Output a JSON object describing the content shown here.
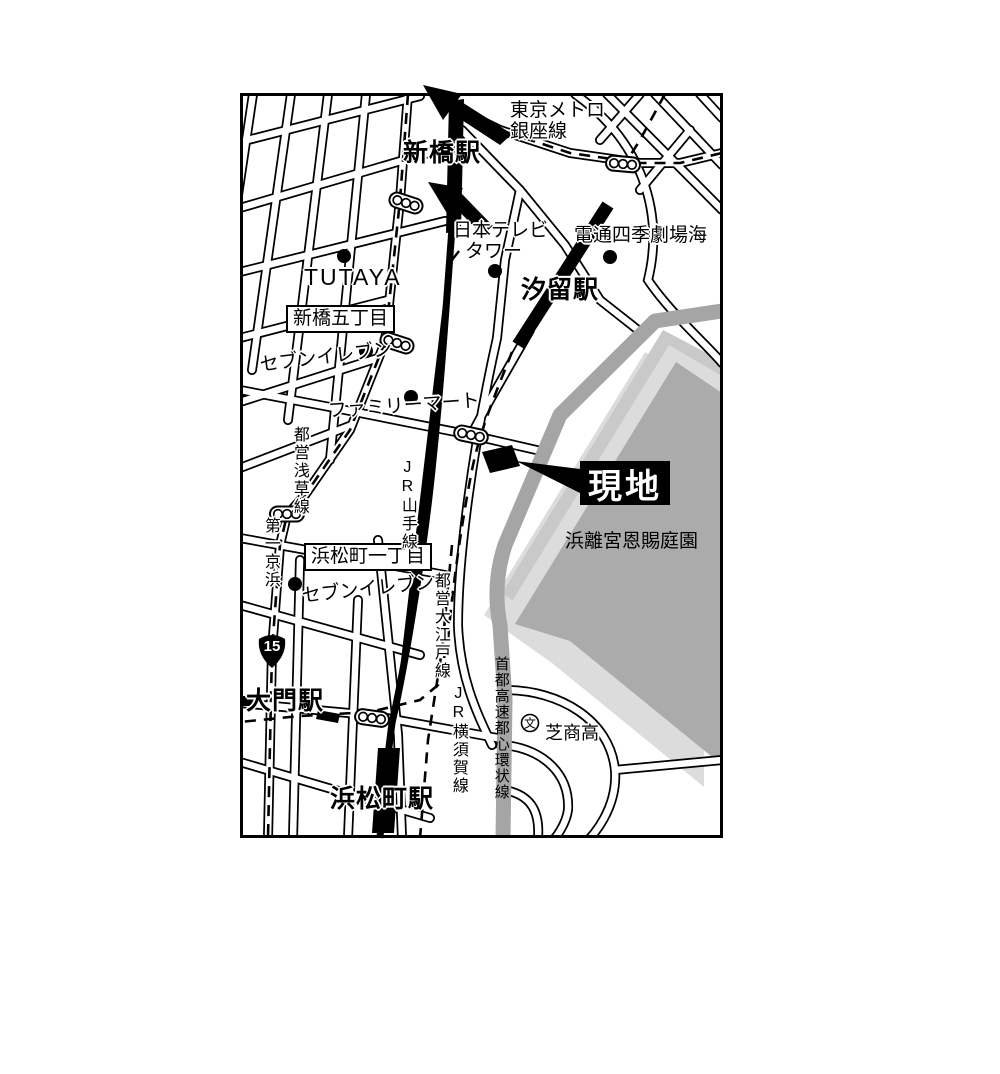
{
  "map": {
    "stations": {
      "shimbashi": "新橋駅",
      "shiodome": "汐留駅",
      "daimon": "大門駅",
      "hamamatsucho": "浜松町駅"
    },
    "railways": {
      "ginza_line1": "東京メトロ",
      "ginza_line2": "銀座線",
      "yamanote": "JR山手線",
      "oedo": "都営大江戸線",
      "yokosuka": "JR横須賀線",
      "asakusa": "都営浅草線",
      "expressway": "首都高速都心環状線"
    },
    "roads": {
      "daiichi_keihin": "第一京浜",
      "route_number": "15"
    },
    "areas": {
      "shimbashi_5chome": "新橋五丁目",
      "hamamatsucho_1chome": "浜松町一丁目",
      "park": "浜離宮恩賜庭園"
    },
    "pois": {
      "tsutaya": "TUTAYA",
      "nittele_line1": "日本テレビ",
      "nittele_line2": "タワー",
      "dentsu_theater": "電通四季劇場海",
      "seven_eleven_north": "セブンイレブン",
      "familymart": "ファミリーマート",
      "seven_eleven_south": "セブンイレブン",
      "school_name": "芝商高",
      "school_symbol": "文"
    },
    "site": {
      "label": "現地"
    },
    "colors": {
      "park_fill": "#ababab",
      "park_bevel_light": "#dcdcdc",
      "park_bevel_mid": "#c9c9c9",
      "expressway_gray": "#a5a5a5",
      "road_line": "#000000",
      "site_marker": "#000000"
    }
  }
}
